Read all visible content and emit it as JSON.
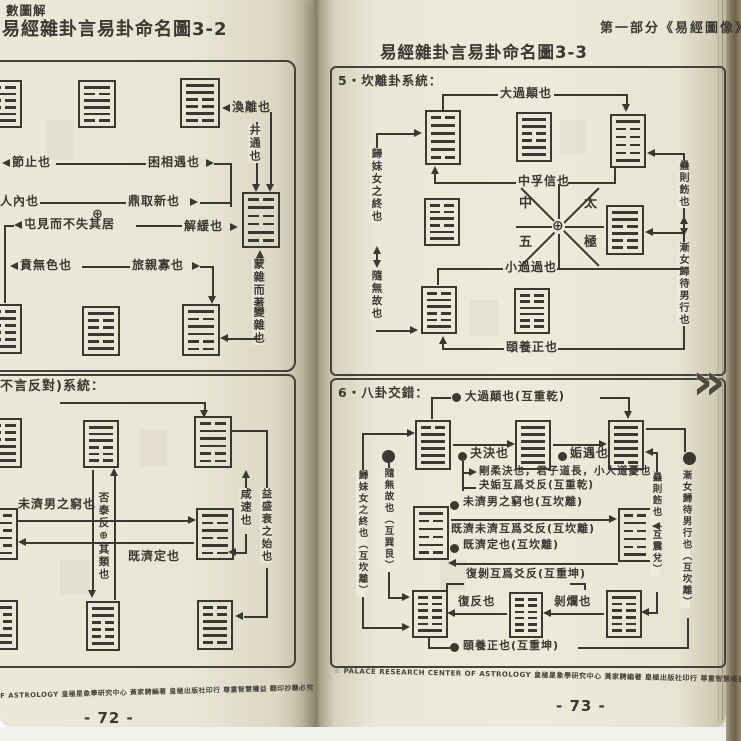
{
  "left": {
    "head": "數圖解",
    "title": "易經雜卦言易卦命名圖3-2",
    "d1": {
      "huan": "渙離也",
      "jing": "井通也",
      "jie": "節止也",
      "kunxg": "困相遇也",
      "jiaren": "人內也",
      "ding": "鼎取新也",
      "plus": "⊕",
      "zhun": "屯見而不失其居",
      "xie": "解緩也",
      "ben": "賁無色也",
      "lu": "旅親寡也",
      "meng": "蒙雜而著",
      "bian": "變雜也"
    },
    "d2": {
      "head": "不言反對)系統：",
      "weiji": "未濟男之窮也",
      "pitai": "否泰反⊕其類也",
      "jiji": "既濟定也",
      "xian": "咸速也",
      "yi": "益盛衰之始也"
    },
    "footer": "F ASTROLOGY 皇極星象學研究中心 黃家騁編著 皇極出版社印行 尊重智慧權益 翻印抄襲必究",
    "pageno": "- 72 -"
  },
  "right": {
    "head": "第一部分《易經圖像》",
    "title": "易經雜卦言易卦命名圖3-3",
    "s5": {
      "head": "5・坎離卦系統：",
      "daguo": "大過顛也",
      "zhongfu": "中孚信也",
      "xiaoguo": "小過過也",
      "yiyang": "頤養正也",
      "guimei": "歸妹女之終也",
      "sui": "隨無故也",
      "gu": "蠱則飭也",
      "jian": "漸女歸待男行也",
      "c1": "中",
      "c2": "太",
      "c3": "五",
      "c4": "極",
      "plus": "⊕"
    },
    "s6": {
      "head": "6・八卦交錯：",
      "daguo": "大過顛也(互重乾)",
      "guai": "夬決也",
      "gou": "姤遇也",
      "l1": "剛柔決也，君子道長，小人道憂也。",
      "l2": "夬姤互爲爻反(互重乾)",
      "weiji": "未濟男之窮也(互坎離)",
      "l3": "既濟未濟互爲爻反(互坎離)",
      "jiji": "既濟定也(互坎離)",
      "l4": "復剝互爲爻反(互重坤)",
      "fu": "復反也",
      "bo": "剝爛也",
      "yi": "頤養正也(互重坤)",
      "guimei": "歸妹女之終也（互坎離）",
      "sui": "隨無故也（互巽艮）",
      "gu": "蠱則飭也（互震兌）",
      "jian": "漸女歸待男行也（互坎離）"
    },
    "footer": "☆ PALACE RESEARCH CENTER OF ASTROLOGY 皇極星象學研究中心 黃家騁編著 皇極出版社印行 尊重智慧權益 翻印抄襲必究 ☆",
    "pageno": "- 73 -"
  },
  "ui": {
    "flip": "»"
  },
  "hexagrams": {
    "jie": [
      "b",
      "s",
      "b",
      "b",
      "s",
      "s"
    ],
    "ding": [
      "s",
      "b",
      "s",
      "s",
      "s",
      "b"
    ],
    "huan": [
      "s",
      "s",
      "b",
      "b",
      "s",
      "b"
    ],
    "kan": [
      "b",
      "s",
      "b",
      "b",
      "s",
      "b"
    ],
    "zhun": [
      "b",
      "s",
      "b",
      "b",
      "b",
      "s"
    ],
    "ben": [
      "s",
      "b",
      "b",
      "s",
      "b",
      "s"
    ],
    "lu": [
      "s",
      "b",
      "s",
      "s",
      "b",
      "b"
    ],
    "tai": [
      "b",
      "b",
      "b",
      "s",
      "s",
      "s"
    ],
    "pi": [
      "s",
      "s",
      "s",
      "b",
      "b",
      "b"
    ],
    "xian": [
      "b",
      "s",
      "s",
      "s",
      "b",
      "b"
    ],
    "jiji": [
      "b",
      "s",
      "b",
      "s",
      "b",
      "s"
    ],
    "weiji": [
      "s",
      "b",
      "s",
      "b",
      "s",
      "b"
    ],
    "sun": [
      "s",
      "b",
      "b",
      "b",
      "s",
      "s"
    ],
    "yi": [
      "s",
      "s",
      "b",
      "b",
      "b",
      "s"
    ],
    "heng": [
      "b",
      "b",
      "s",
      "s",
      "s",
      "b"
    ],
    "daguo": [
      "b",
      "s",
      "s",
      "s",
      "s",
      "b"
    ],
    "zhongfu": [
      "s",
      "s",
      "b",
      "b",
      "s",
      "s"
    ],
    "yiH": [
      "s",
      "b",
      "b",
      "b",
      "b",
      "s"
    ],
    "guimei": [
      "b",
      "b",
      "s",
      "b",
      "s",
      "s"
    ],
    "jian": [
      "s",
      "s",
      "b",
      "s",
      "b",
      "b"
    ],
    "sui": [
      "b",
      "s",
      "s",
      "b",
      "b",
      "s"
    ],
    "xiaoguo": [
      "b",
      "b",
      "s",
      "s",
      "b",
      "b"
    ],
    "guai": [
      "b",
      "s",
      "s",
      "s",
      "s",
      "s"
    ],
    "qian": [
      "s",
      "s",
      "s",
      "s",
      "s",
      "s"
    ],
    "gou": [
      "s",
      "s",
      "s",
      "s",
      "s",
      "b"
    ],
    "fu": [
      "b",
      "b",
      "b",
      "b",
      "b",
      "s"
    ],
    "kun": [
      "b",
      "b",
      "b",
      "b",
      "b",
      "b"
    ],
    "bo": [
      "s",
      "b",
      "b",
      "b",
      "b",
      "b"
    ]
  }
}
